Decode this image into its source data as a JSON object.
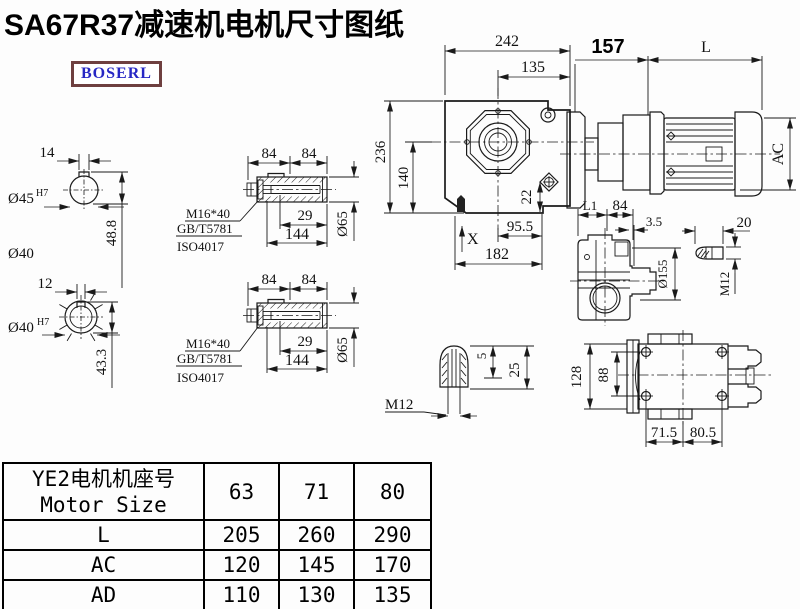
{
  "title": "SA67R37减速机电机尺寸图纸",
  "logo": "BOSERL",
  "colors": {
    "line": "#1a1a1a",
    "logo_text": "#2727c4",
    "logo_border": "#6e3f3f",
    "background": "#fdfdfd"
  },
  "drawing": {
    "bore1": {
      "key_width": "14",
      "bore": "Ø45",
      "fit": "H7",
      "depth": "48.8",
      "outer": "Ø40"
    },
    "bore2": {
      "key_width": "12",
      "bore": "Ø40",
      "fit": "H7",
      "depth": "43.3"
    },
    "shaft1": {
      "seg_a": "84",
      "seg_b": "84",
      "bolt": "M16*40",
      "std1": "GB/T5781",
      "std2": "ISO4017",
      "len_a": "29",
      "len_b": "144",
      "dia": "Ø65"
    },
    "shaft2": {
      "seg_a": "84",
      "seg_b": "84",
      "bolt": "M16*40",
      "std1": "GB/T5781",
      "std2": "ISO4017",
      "len_a": "29",
      "len_b": "144",
      "dia": "Ø65"
    },
    "front": {
      "w242": "242",
      "w135": "135",
      "w157": "157",
      "wL": "L",
      "h236": "236",
      "h140": "140",
      "d22": "22",
      "ac": "AC",
      "w955": "95.5",
      "w182": "182",
      "x_mark": "X"
    },
    "side": {
      "l1": "L1",
      "w84": "84",
      "w35": "3.5",
      "d155": "Ø155",
      "k20": "20",
      "m12": "M12"
    },
    "thread": {
      "m12": "M12",
      "d5": "5",
      "d25": "25"
    },
    "bottom": {
      "h128": "128",
      "h88": "88",
      "w715": "71.5",
      "w805": "80.5"
    }
  },
  "table": {
    "header_cn": "YE2电机机座号",
    "header_en": "Motor Size",
    "sizes": [
      "63",
      "71",
      "80"
    ],
    "rows": [
      {
        "label": "L",
        "values": [
          "205",
          "260",
          "290"
        ]
      },
      {
        "label": "AC",
        "values": [
          "120",
          "145",
          "170"
        ]
      },
      {
        "label": "AD",
        "values": [
          "110",
          "130",
          "135"
        ]
      }
    ]
  }
}
